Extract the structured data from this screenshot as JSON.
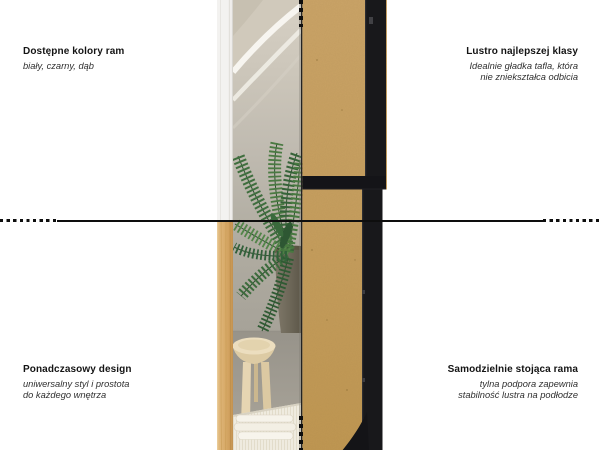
{
  "annotations": {
    "top_left": {
      "title": "Dostępne kolory ram",
      "subtitle": "biały, czarny, dąb"
    },
    "top_right": {
      "title": "Lustro najlepszej klasy",
      "subtitle": "Idealnie gładka tafla, która\nnie zniekształca odbicia"
    },
    "bottom_left": {
      "title": "Ponadczasowy design",
      "subtitle": "uniwersalny styl i prostota\ndo każdego wnętrza"
    },
    "bottom_right": {
      "title": "Samodzielnie stojąca rama",
      "subtitle": "tylna podpora zapewnia\nstabilność lustra na podłodze"
    }
  },
  "image": {
    "description": "split product photo: mirror front reflecting interior with palm plant (left), MDF back with black frame and stand (right)",
    "frame_colors_shown": [
      "biały",
      "dąb",
      "czarny"
    ]
  },
  "colors": {
    "background": "#ffffff",
    "text": "#141414",
    "line": "#0e0e0e",
    "frame_black": "#18181b",
    "frame_white": "#f3f2f0",
    "frame_oak": "#d8ab69",
    "mdf": "#c69e5e",
    "plant_green": "#3c6b3c",
    "wall_gray": "#b1ada2",
    "floor_gray": "#a09b91"
  }
}
